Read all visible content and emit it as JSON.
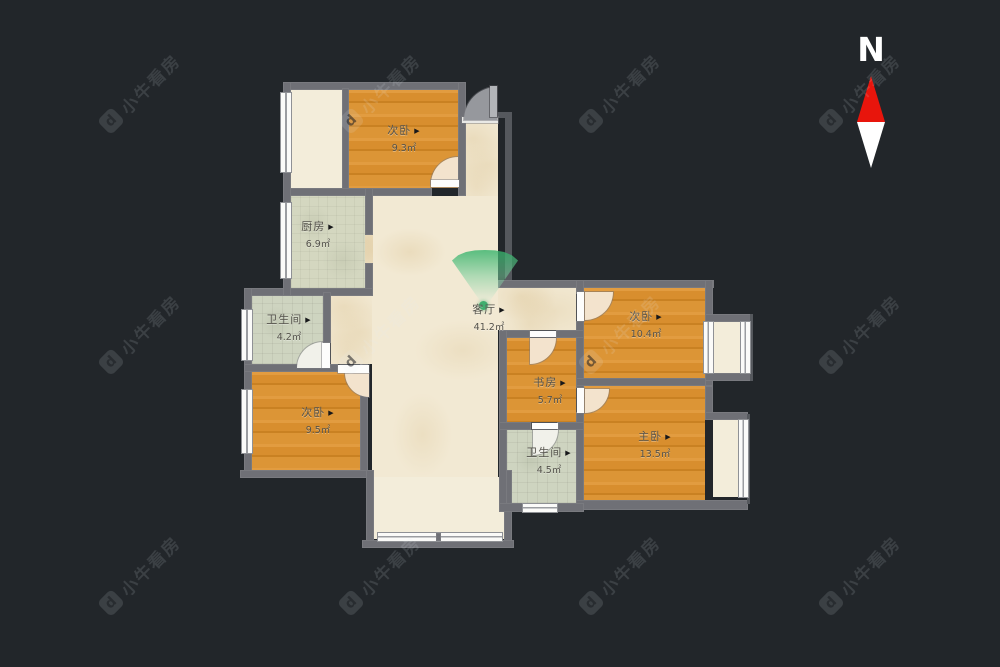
{
  "compass": {
    "label": "N"
  },
  "watermark": {
    "text": "小牛看房"
  },
  "ui": {
    "marker": "▶"
  },
  "rooms": [
    {
      "id": "bedroom-top",
      "name": "次卧",
      "area": "9.3㎡"
    },
    {
      "id": "kitchen",
      "name": "厨房",
      "area": "6.9㎡"
    },
    {
      "id": "living-room",
      "name": "客厅",
      "area": "41.2㎡"
    },
    {
      "id": "bathroom-left",
      "name": "卫生间",
      "area": "4.2㎡"
    },
    {
      "id": "bedroom-left",
      "name": "次卧",
      "area": "9.5㎡"
    },
    {
      "id": "study",
      "name": "书房",
      "area": "5.7㎡"
    },
    {
      "id": "bedroom-right",
      "name": "次卧",
      "area": "10.4㎡"
    },
    {
      "id": "master-bedroom",
      "name": "主卧",
      "area": "13.5㎡"
    },
    {
      "id": "bathroom-mid",
      "name": "卫生间",
      "area": "4.5㎡"
    }
  ],
  "colors": {
    "background": "#22262a",
    "wall": "#6f7076",
    "wood_floor": "#db9334",
    "marble_floor": "#f2e9d3",
    "tile_floor": "#d4d7c0",
    "balcony_floor": "#f3edda",
    "viewpoint_green": "#3fae6e",
    "compass_red": "#e8150c"
  }
}
